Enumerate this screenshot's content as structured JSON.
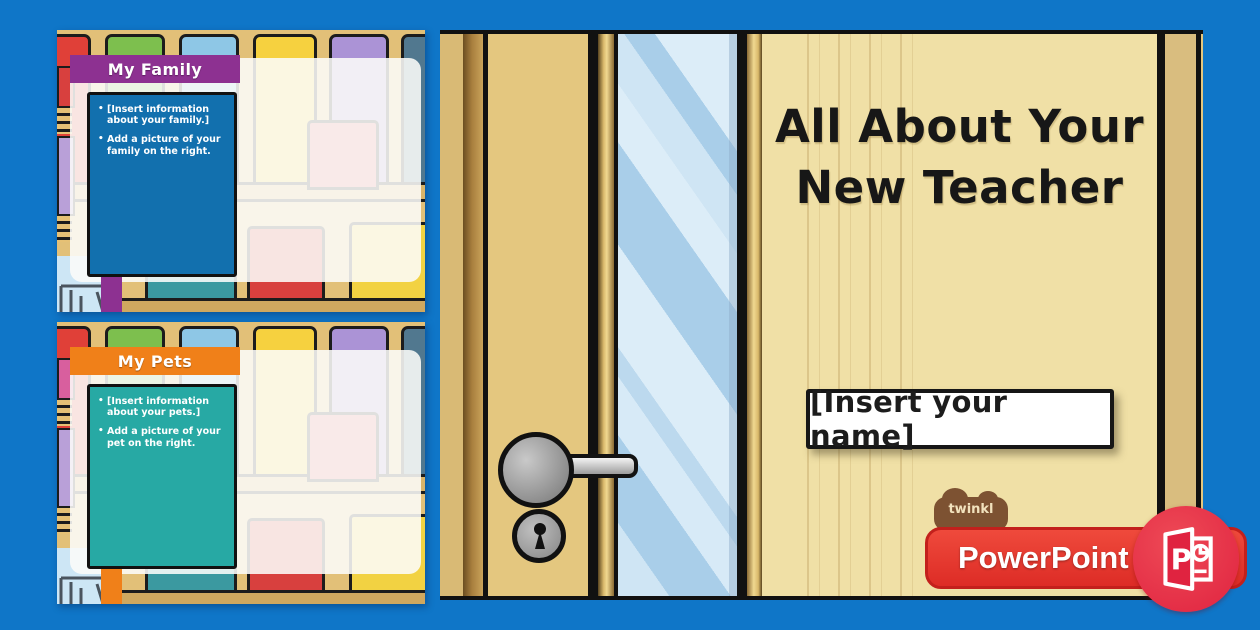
{
  "page": {
    "background_color": "#0f76c8",
    "type_label": "PowerPoint resource preview"
  },
  "slides": [
    {
      "title": "My Family",
      "title_bg": "#8d3191",
      "book_color": "#1270ae",
      "bullets": [
        "[Insert information about your family.]",
        "Add a picture of your family on the right."
      ]
    },
    {
      "title": "My Pets",
      "title_bg": "#f08019",
      "book_color": "#27a9a4",
      "bullets": [
        "[Insert information about your pets.]",
        "Add a picture of your pet on the right."
      ]
    }
  ],
  "door": {
    "title_line1": "All About Your",
    "title_line2": "New Teacher",
    "name_text": "[Insert your name]",
    "wood_color": "#f0e0a6",
    "glass_color": "#cfe5f4"
  },
  "branding": {
    "logo_text": "twinkl",
    "logo_color": "#7d5232",
    "app_label": "PowerPoint",
    "banner_color": "#e0362c",
    "icon": "powerpoint-icon"
  }
}
